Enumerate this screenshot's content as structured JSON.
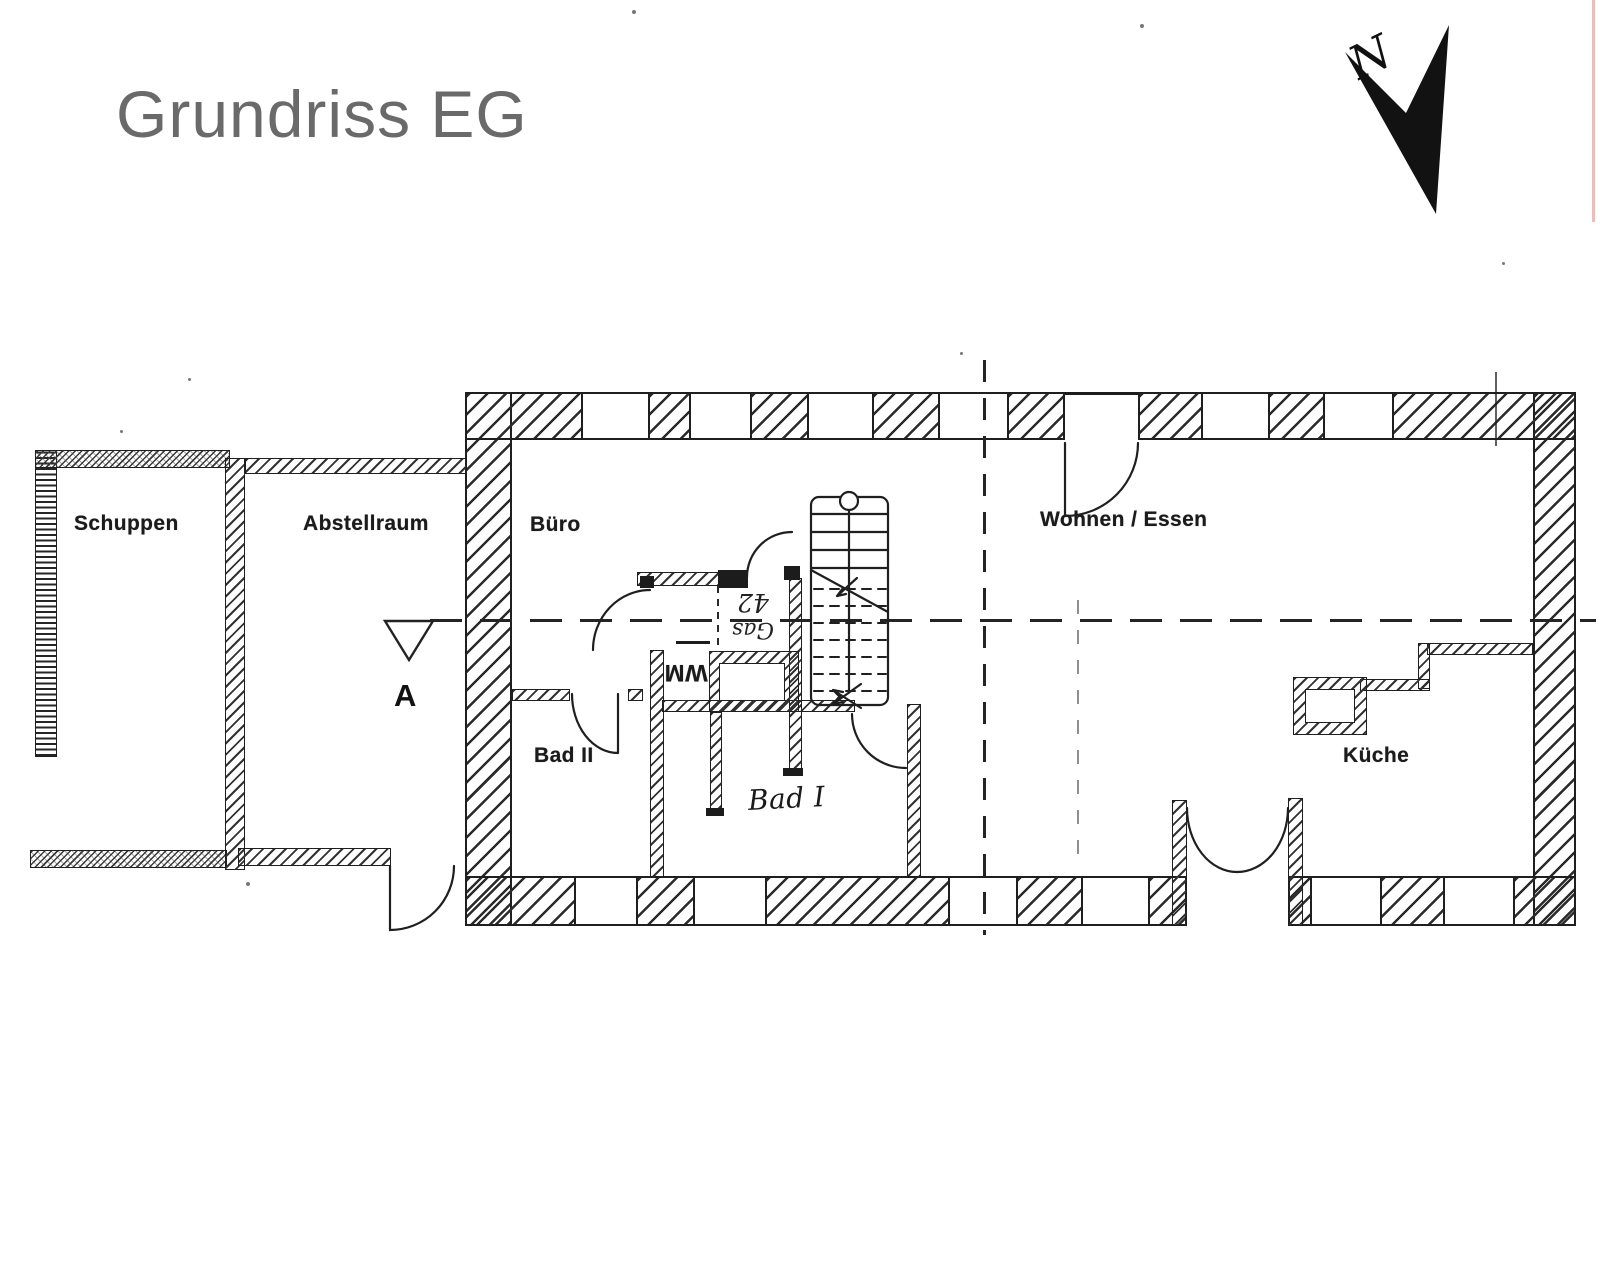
{
  "page": {
    "title": "Grundriss EG"
  },
  "compass": {
    "label": "N"
  },
  "rooms": {
    "schuppen": {
      "label": "Schuppen"
    },
    "abstellraum": {
      "label": "Abstellraum"
    },
    "buero": {
      "label": "Büro"
    },
    "wohnen_essen": {
      "label": "Wohnen / Essen"
    },
    "bad2": {
      "label": "Bad II"
    },
    "bad1": {
      "label": "Bad I"
    },
    "kueche": {
      "label": "Küche"
    }
  },
  "annotations": {
    "washing_machine": "WM",
    "gas_label": "Gas",
    "gas_value": "42",
    "section_marker": "A"
  },
  "colors": {
    "ink": "#1f1f1f",
    "title_gray": "#6a6a6a"
  }
}
